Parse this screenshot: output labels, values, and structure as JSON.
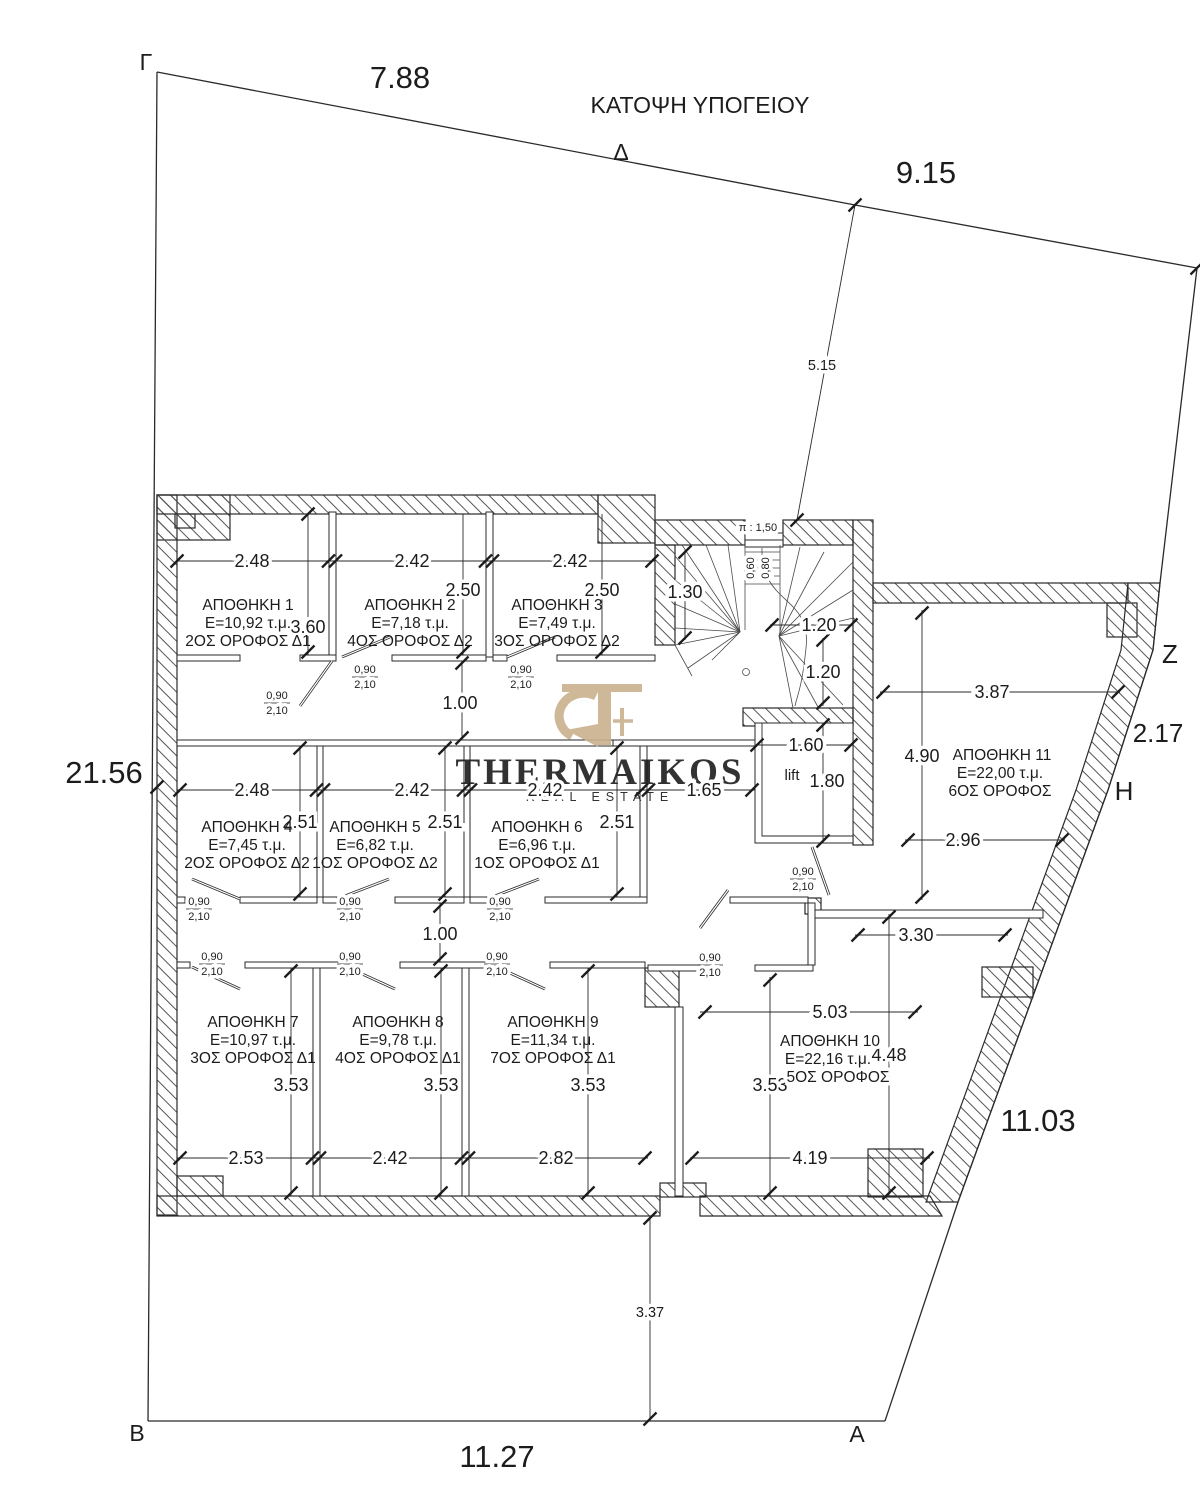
{
  "title": "ΚΑΤΟΨΗ ΥΠΟΓΕΙΟΥ",
  "logo": {
    "name": "THERMAIKOS",
    "subtitle": "REAL ESTATE",
    "tan": "#c9b18c",
    "gray": "#9b9b9b",
    "light_gray": "#b6b6b6"
  },
  "plot": {
    "vertices": {
      "gamma": "Γ",
      "delta": "Δ",
      "zeta": "Z",
      "eta": "H",
      "alpha": "A",
      "beta": "B"
    },
    "dims": {
      "top_left": "7.88",
      "top_right": "9.15",
      "left": "21.56",
      "bottom": "11.27",
      "right_lower": "11.03",
      "right_upper": "2.17",
      "setback_top": "5.15",
      "setback_bottom": "3.37"
    }
  },
  "rooms": [
    {
      "name": "ΑΠΟΘΗΚΗ 1",
      "area": "Ε=10,92 τ.μ.",
      "floor": "2ΟΣ ΟΡΟΦΟΣ Δ1",
      "w": "2.48",
      "h": "3.60"
    },
    {
      "name": "ΑΠΟΘΗΚΗ 2",
      "area": "Ε=7,18 τ.μ.",
      "floor": "4ΟΣ ΟΡΟΦΟΣ Δ2",
      "w": "2.42",
      "h": "2.50"
    },
    {
      "name": "ΑΠΟΘΗΚΗ 3",
      "area": "Ε=7,49 τ.μ.",
      "floor": "3ΟΣ ΟΡΟΦΟΣ Δ2",
      "w": "2.42",
      "h": "2.50"
    },
    {
      "name": "ΑΠΟΘΗΚΗ 4",
      "area": "Ε=7,45 τ.μ.",
      "floor": "2ΟΣ ΟΡΟΦΟΣ Δ2",
      "w": "2.48",
      "h": "2.51"
    },
    {
      "name": "ΑΠΟΘΗΚΗ 5",
      "area": "Ε=6,82 τ.μ.",
      "floor": "1ΟΣ ΟΡΟΦΟΣ Δ2",
      "w": "2.42",
      "h": "2.51"
    },
    {
      "name": "ΑΠΟΘΗΚΗ 6",
      "area": "Ε=6,96 τ.μ.",
      "floor": "1ΟΣ ΟΡΟΦΟΣ Δ1",
      "w": "2.42",
      "h": "2.51"
    },
    {
      "name": "ΑΠΟΘΗΚΗ 7",
      "area": "Ε=10,97 τ.μ.",
      "floor": "3ΟΣ ΟΡΟΦΟΣ Δ1",
      "w": "2.53",
      "h": "3.53"
    },
    {
      "name": "ΑΠΟΘΗΚΗ 8",
      "area": "Ε=9,78 τ.μ.",
      "floor": "4ΟΣ ΟΡΟΦΟΣ Δ1",
      "w": "2.42",
      "h": "3.53"
    },
    {
      "name": "ΑΠΟΘΗΚΗ 9",
      "area": "Ε=11,34 τ.μ.",
      "floor": "7ΟΣ ΟΡΟΦΟΣ Δ1",
      "w": "2.82",
      "h": "3.53"
    },
    {
      "name": "ΑΠΟΘΗΚΗ 10",
      "area": "Ε=22,16 τ.μ.",
      "floor": "5ΟΣ ΟΡΟΦΟΣ",
      "w": "4.19",
      "h": "3.53",
      "h2": "4.48",
      "top": "5.03",
      "top2": "3.30"
    },
    {
      "name": "ΑΠΟΘΗΚΗ 11",
      "area": "Ε=22,00 τ.μ.",
      "floor": "6ΟΣ ΟΡΟΦΟΣ",
      "w": "3.87",
      "h": "4.90",
      "bottom": "2.96"
    }
  ],
  "corridor": {
    "width_1": "1.00",
    "width_2": "1.00",
    "lift_dim": "1.65"
  },
  "stairs": {
    "label_pitch": "π : 1,50",
    "tread_a": "0,60",
    "tread_b": "0,80",
    "dim_width": "1.30",
    "dim_a": "1.20",
    "dim_b": "1.20"
  },
  "lift": {
    "label": "lift",
    "w": "1.60",
    "h": "1.80"
  },
  "door": {
    "w": "0,90",
    "h": "2,10"
  }
}
